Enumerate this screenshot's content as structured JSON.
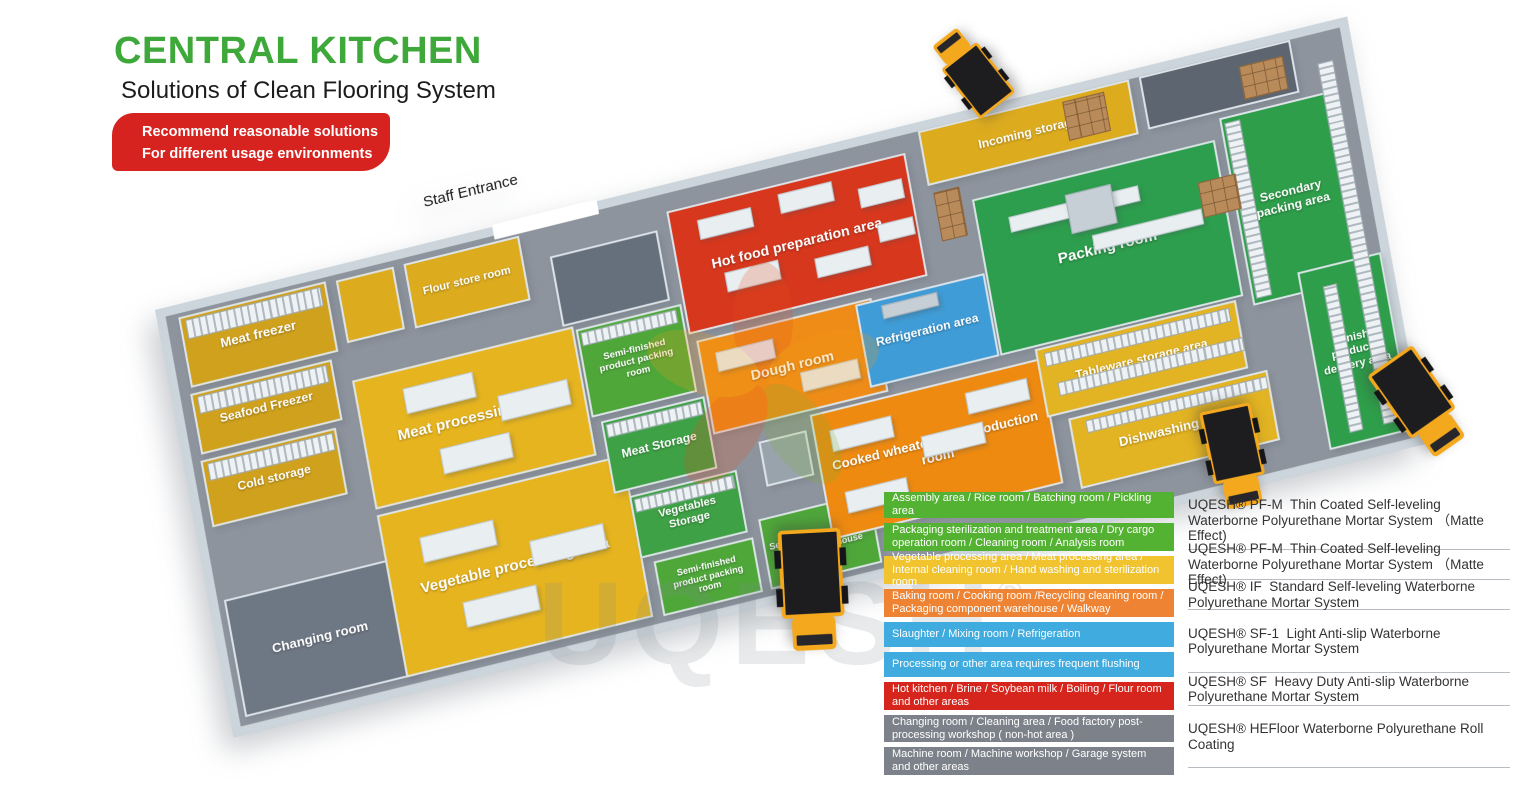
{
  "header": {
    "title": "CENTRAL KITCHEN",
    "subtitle": "Solutions of Clean Flooring System",
    "banner_line1": "Recommend reasonable solutions",
    "banner_line2": "For different usage environments",
    "title_color": "#3fa83b",
    "banner_color": "#d7231f"
  },
  "plan": {
    "entrance_label": "Staff Entrance",
    "watermark": "UQESH",
    "watermark_reg": "®",
    "rooms": [
      {
        "id": "meat-freezer",
        "label": "Meat freezer",
        "x": 12,
        "y": 4,
        "w": 148,
        "h": 72,
        "color": "#cfa11d",
        "fs": 13
      },
      {
        "id": "seafood-freezer",
        "label": "Seafood Freezer",
        "x": 10,
        "y": 82,
        "w": 142,
        "h": 62,
        "color": "#cfa11d",
        "fs": 12
      },
      {
        "id": "cold-storage",
        "label": "Cold storage",
        "x": 8,
        "y": 150,
        "w": 136,
        "h": 68,
        "color": "#cfa11d",
        "fs": 12
      },
      {
        "id": "changing-room",
        "label": "Changing room",
        "x": 6,
        "y": 292,
        "w": 172,
        "h": 120,
        "color": "#6e7784",
        "fs": 13
      },
      {
        "id": "storage-small",
        "label": "",
        "x": 170,
        "y": 6,
        "w": 58,
        "h": 64,
        "color": "#dcab1e",
        "fs": 10
      },
      {
        "id": "flour-store-room",
        "label": "Flour store room",
        "x": 238,
        "y": 6,
        "w": 116,
        "h": 66,
        "color": "#dcab1e",
        "fs": 11
      },
      {
        "id": "staff-vestibule",
        "label": "",
        "x": 380,
        "y": 34,
        "w": 108,
        "h": 72,
        "color": "#66707d",
        "fs": 10
      },
      {
        "id": "meat-processing-area",
        "label": "Meat processing area",
        "x": 168,
        "y": 108,
        "w": 222,
        "h": 132,
        "color": "#e6b41f",
        "fs": 15
      },
      {
        "id": "vegetable-processing-area",
        "label": "Vegetable processing area",
        "x": 168,
        "y": 246,
        "w": 248,
        "h": 166,
        "color": "#e6b41f",
        "fs": 15
      },
      {
        "id": "semi-finished-packing-room-1",
        "label": "Semi-finished product packing room",
        "x": 392,
        "y": 112,
        "w": 106,
        "h": 90,
        "color": "#4fa73a",
        "fs": 9.5
      },
      {
        "id": "meat-storage",
        "label": "Meat Storage",
        "x": 400,
        "y": 208,
        "w": 104,
        "h": 74,
        "color": "#3ea145",
        "fs": 12
      },
      {
        "id": "vegetables-storage",
        "label": "Vegetables Storage",
        "x": 414,
        "y": 288,
        "w": 108,
        "h": 64,
        "color": "#3ea145",
        "fs": 11
      },
      {
        "id": "semi-finished-packing-room-2",
        "label": "Semi-finished product packing room",
        "x": 426,
        "y": 358,
        "w": 100,
        "h": 56,
        "color": "#4fa73a",
        "fs": 9
      },
      {
        "id": "semi-finished-delivery-warehouse",
        "label": "Semi-finished products delivery warehouse",
        "x": 534,
        "y": 342,
        "w": 112,
        "h": 72,
        "color": "#4fa73a",
        "fs": 9
      },
      {
        "id": "hot-food-preparation-area",
        "label": "Hot food preparation area",
        "x": 500,
        "y": 18,
        "w": 240,
        "h": 126,
        "color": "#d6371d",
        "fs": 14
      },
      {
        "id": "dough-room",
        "label": "Dough room",
        "x": 506,
        "y": 152,
        "w": 176,
        "h": 96,
        "color": "#ef8c17",
        "fs": 14
      },
      {
        "id": "partition-room",
        "label": "",
        "x": 548,
        "y": 266,
        "w": 48,
        "h": 46,
        "color": "#99a3ac",
        "fs": 9
      },
      {
        "id": "refrigeration-area",
        "label": "Refrigeration area",
        "x": 665,
        "y": 155,
        "w": 130,
        "h": 85,
        "color": "#3f9cd6",
        "fs": 12
      },
      {
        "id": "cooked-wheaten-food-production-room",
        "label": "Cooked wheaten food production room",
        "x": 602,
        "y": 252,
        "w": 232,
        "h": 128,
        "color": "#ee8a10",
        "fs": 13
      },
      {
        "id": "incoming-storage",
        "label": "Incoming storage",
        "x": 756,
        "y": 0,
        "w": 212,
        "h": 56,
        "color": "#dcab1e",
        "fs": 12
      },
      {
        "id": "top-right-room",
        "label": "",
        "x": 978,
        "y": 0,
        "w": 152,
        "h": 54,
        "color": "#5d6570",
        "fs": 10
      },
      {
        "id": "packing-room",
        "label": "Packing room",
        "x": 796,
        "y": 80,
        "w": 244,
        "h": 160,
        "color": "#2d9e4d",
        "fs": 15
      },
      {
        "id": "tableware-storage-area",
        "label": "Tableware storage area",
        "x": 830,
        "y": 242,
        "w": 202,
        "h": 70,
        "color": "#e2b322",
        "fs": 12
      },
      {
        "id": "dishwashing-area",
        "label": "Dishwashing area",
        "x": 850,
        "y": 318,
        "w": 200,
        "h": 72,
        "color": "#e2b322",
        "fs": 13
      },
      {
        "id": "secondary-packing-area",
        "label": "Secondary packing area",
        "x": 1048,
        "y": 60,
        "w": 112,
        "h": 192,
        "color": "#2e9e4a",
        "fs": 12
      },
      {
        "id": "finish-products-delivery-area",
        "label": "Finish products delivery area",
        "x": 1096,
        "y": 230,
        "w": 84,
        "h": 182,
        "color": "#2e9e4a",
        "fs": 11
      }
    ],
    "objects": [
      {
        "t": "shelf",
        "x": 18,
        "y": 8,
        "w": 136,
        "h": 20
      },
      {
        "t": "shelf",
        "x": 16,
        "y": 86,
        "w": 130,
        "h": 18
      },
      {
        "t": "shelf",
        "x": 14,
        "y": 154,
        "w": 126,
        "h": 18
      },
      {
        "t": "shelf",
        "x": 396,
        "y": 116,
        "w": 96,
        "h": 14
      },
      {
        "t": "shelf",
        "x": 404,
        "y": 212,
        "w": 96,
        "h": 14
      },
      {
        "t": "shelf",
        "x": 418,
        "y": 292,
        "w": 100,
        "h": 14
      },
      {
        "t": "shelf",
        "x": 838,
        "y": 248,
        "w": 186,
        "h": 14
      },
      {
        "t": "shelf",
        "x": 846,
        "y": 280,
        "w": 186,
        "h": 14
      },
      {
        "t": "shelf",
        "x": 866,
        "y": 324,
        "w": 182,
        "h": 13
      },
      {
        "t": "shelfv",
        "x": 1052,
        "y": 66,
        "w": 16,
        "h": 180
      },
      {
        "t": "shelfv",
        "x": 1152,
        "y": 30,
        "w": 16,
        "h": 370
      },
      {
        "t": "shelfv",
        "x": 1118,
        "y": 250,
        "w": 14,
        "h": 150
      },
      {
        "t": "table",
        "x": 215,
        "y": 128,
        "w": 70,
        "h": 26
      },
      {
        "t": "table",
        "x": 305,
        "y": 158,
        "w": 70,
        "h": 26
      },
      {
        "t": "table",
        "x": 240,
        "y": 196,
        "w": 70,
        "h": 26
      },
      {
        "t": "table",
        "x": 205,
        "y": 278,
        "w": 74,
        "h": 26
      },
      {
        "t": "table",
        "x": 310,
        "y": 308,
        "w": 74,
        "h": 26
      },
      {
        "t": "table",
        "x": 235,
        "y": 352,
        "w": 74,
        "h": 26
      },
      {
        "t": "table",
        "x": 528,
        "y": 34,
        "w": 54,
        "h": 20
      },
      {
        "t": "table",
        "x": 610,
        "y": 28,
        "w": 54,
        "h": 20
      },
      {
        "t": "table",
        "x": 688,
        "y": 42,
        "w": 44,
        "h": 20
      },
      {
        "t": "table",
        "x": 545,
        "y": 92,
        "w": 54,
        "h": 20
      },
      {
        "t": "table",
        "x": 634,
        "y": 100,
        "w": 54,
        "h": 20
      },
      {
        "t": "table",
        "x": 700,
        "y": 82,
        "w": 36,
        "h": 18
      },
      {
        "t": "table",
        "x": 522,
        "y": 168,
        "w": 58,
        "h": 20
      },
      {
        "t": "table",
        "x": 600,
        "y": 208,
        "w": 58,
        "h": 20
      },
      {
        "t": "table",
        "x": 618,
        "y": 272,
        "w": 62,
        "h": 22
      },
      {
        "t": "table",
        "x": 705,
        "y": 300,
        "w": 62,
        "h": 22
      },
      {
        "t": "table",
        "x": 622,
        "y": 336,
        "w": 62,
        "h": 22
      },
      {
        "t": "table",
        "x": 755,
        "y": 268,
        "w": 62,
        "h": 22
      },
      {
        "t": "table",
        "x": 828,
        "y": 106,
        "w": 130,
        "h": 16
      },
      {
        "t": "machine",
        "x": 886,
        "y": 98,
        "w": 46,
        "h": 40
      },
      {
        "t": "table",
        "x": 905,
        "y": 144,
        "w": 110,
        "h": 16
      },
      {
        "t": "machine",
        "x": 690,
        "y": 162,
        "w": 56,
        "h": 14
      },
      {
        "t": "boxes",
        "x": 900,
        "y": 6,
        "w": 42,
        "h": 40
      },
      {
        "t": "boxes",
        "x": 760,
        "y": 64,
        "w": 26,
        "h": 50
      },
      {
        "t": "boxes",
        "x": 1076,
        "y": 14,
        "w": 44,
        "h": 34
      },
      {
        "t": "boxes",
        "x": 1016,
        "y": 118,
        "w": 38,
        "h": 36
      }
    ],
    "entrance_gap": {
      "x": 330,
      "y": -11,
      "w": 105,
      "h": 15
    },
    "entrance_label_pos": {
      "x": 268,
      "y": -58
    },
    "trucks": [
      {
        "x": 935,
        "y": 25,
        "w": 72,
        "h": 92,
        "rot": -38
      },
      {
        "x": 1385,
        "y": 348,
        "w": 70,
        "h": 112,
        "rot": 145
      },
      {
        "x": 1203,
        "y": 400,
        "w": 64,
        "h": 114,
        "rot": 168
      },
      {
        "x": 773,
        "y": 526,
        "w": 78,
        "h": 128,
        "rot": 177
      }
    ]
  },
  "legend": {
    "rows": [
      {
        "color": "#53b232",
        "text": "Assembly area / Rice room / Batching room / Pickling area"
      },
      {
        "color": "#53b232",
        "text": "Packaging sterilization and treatment area / Dry cargo operation room / Cleaning room / Analysis room"
      },
      {
        "color": "#f0c32f",
        "text": "Vegetable processing area / Meat processing area / Internal cleaning room / Hand washing and sterilization room"
      },
      {
        "color": "#ee8433",
        "text": "Baking room / Cooking room /Recycling cleaning room / Packaging component warehouse / Walkway"
      },
      {
        "color": "#3fabdf",
        "text": "Slaughter / Mixing room / Refrigeration"
      },
      {
        "color": "#3fabdf",
        "text": "Processing or other area requires frequent flushing"
      },
      {
        "color": "#d6251d",
        "text": "Hot kitchen / Brine / Soybean milk / Boiling / Flour room and other areas"
      },
      {
        "color": "#7d828a",
        "text": "Changing room / Cleaning area / Food factory post-processing workshop ( non-hot area )"
      },
      {
        "color": "#7d828a",
        "text": "Machine room / Machine workshop / Garage system and other areas"
      }
    ],
    "products": [
      {
        "text": "UQESH® PF-M  Thin Coated Self-leveling Waterborne Polyurethane Mortar System （Matte Effect)"
      },
      {
        "text": "UQESH® PF-M  Thin Coated Self-leveling Waterborne Polyurethane Mortar System （Matte Effect)"
      },
      {
        "text": "UQESH® IF  Standard Self-leveling Waterborne Polyurethane Mortar System"
      },
      {
        "text": "UQESH® SF-1  Light Anti-slip Waterborne Polyurethane Mortar System"
      },
      {
        "text": "UQESH® SF  Heavy Duty Anti-slip Waterborne Polyurethane Mortar System"
      },
      {
        "text": "UQESH® HEFloor Waterborne Polyurethane Roll Coating"
      }
    ]
  }
}
